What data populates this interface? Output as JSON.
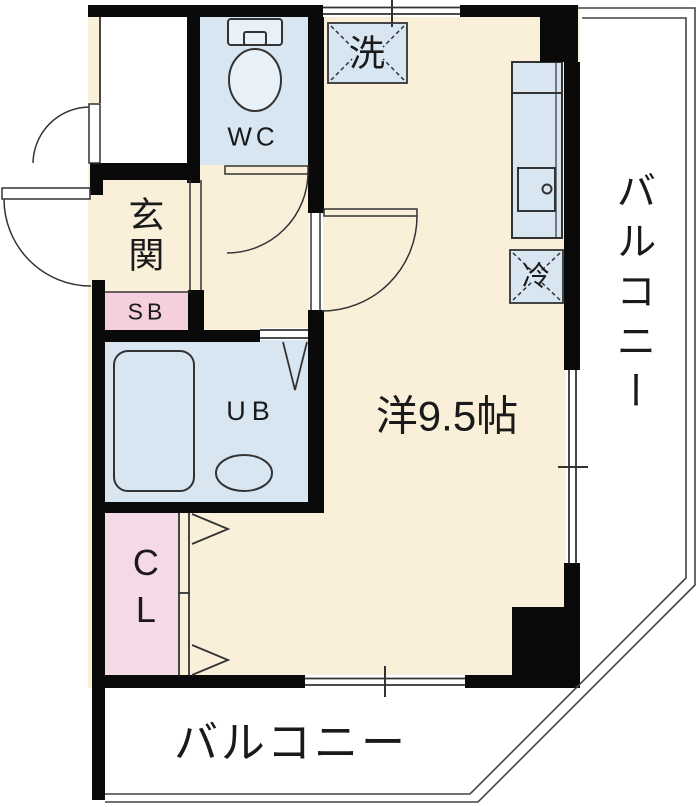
{
  "floorplan": {
    "type": "apartment-floor-plan",
    "rooms": {
      "wc": {
        "label": "WC"
      },
      "genkan": {
        "label": "玄関"
      },
      "shoe_box": {
        "label": "SB"
      },
      "unit_bath": {
        "label": "UB"
      },
      "closet": {
        "label": "CL"
      },
      "living": {
        "label": "洋9.5帖"
      },
      "balcony_right": {
        "label": "バルコニー"
      },
      "balcony_bottom": {
        "label": "バルコニー"
      }
    },
    "fixtures": {
      "washer_space": {
        "label": "洗"
      },
      "refrigerator_space": {
        "label": "冷"
      }
    },
    "colors": {
      "room_floor": "#FAF0DA",
      "wet_area": "#D8E6F2",
      "fixture_fill": "#E9F1F8",
      "shoe_box": "#F5CFDD",
      "closet": "#F6D9E6",
      "wall": "#0A0A0A",
      "line": "#333333",
      "balcony": "#FFFFFF",
      "text": "#1A1A1A"
    }
  }
}
